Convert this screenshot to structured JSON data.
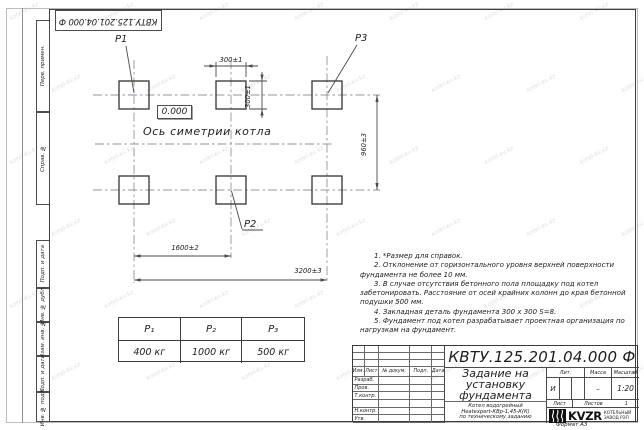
{
  "page": {
    "watermark": "kotel-kv.kz",
    "format": "Формат А3"
  },
  "margin": {
    "designation": "КВТУ.125.201.04.000  Ф",
    "stamps": [
      "Перв. примен.",
      "Справ. №",
      "Подп. и дата",
      "Инв. № дубл.",
      "Взам. инв. №",
      "Подп. и дата",
      "Инв. № подл."
    ]
  },
  "drawing": {
    "p1": "P1",
    "p2": "P2",
    "p3": "P3",
    "elevation": "0.000",
    "axis": "Ось симетрии котла",
    "dim_width": "300±1",
    "dim_height": "300±1",
    "dim_vertical": "960±3",
    "dim_span_half": "1600±2",
    "dim_span_full": "3200±3"
  },
  "notes": [
    "1. *Размер для справок.",
    "2. Отклонение от горизонтального уровня верхней поверхности фундамента не более 10 мм.",
    "3. В случае отсутствия бетонного пола площадку под котел забетонировать. Расстояние от осей крайних колонн до края бетонной подушки 500 мм.",
    "4. Закладная деталь фундамента  300 х 300  S=8.",
    "5. Фундамент под котел разрабатывает проектная организация по нагрузкам на фундамент."
  ],
  "load_table": {
    "headers": [
      "P₁",
      "P₂",
      "P₃"
    ],
    "values": [
      "400 кг",
      "1000 кг",
      "500 кг"
    ]
  },
  "title_block": {
    "designation": "КВТУ.125.201.04.000  Ф",
    "title_lines": [
      "Задание на",
      "установку",
      "фундамента"
    ],
    "subtitle_lines": [
      "Котел водогрейный",
      "Heatexpert-КВр-1,45-К(К)",
      "по техническому заданию"
    ],
    "col_headers": [
      "Изм.",
      "Лист",
      "№ докум.",
      "Подп.",
      "Дата"
    ],
    "row_labels": [
      "Разраб.",
      "Пров.",
      "Т.контр.",
      "",
      "Н.контр.",
      "Утв."
    ],
    "lit_header": "Лит.",
    "lit_value": "И",
    "mass_header": "Масса",
    "mass_value": "–",
    "scale_header": "Масштаб",
    "scale_value": "1:20",
    "sheet_label": "Лист",
    "sheets_label": "Листов",
    "sheets_value": "1",
    "logo": "KVZR",
    "company": [
      "КОТЕЛЬНЫЙ",
      "ЗАВОД РЭП"
    ]
  }
}
